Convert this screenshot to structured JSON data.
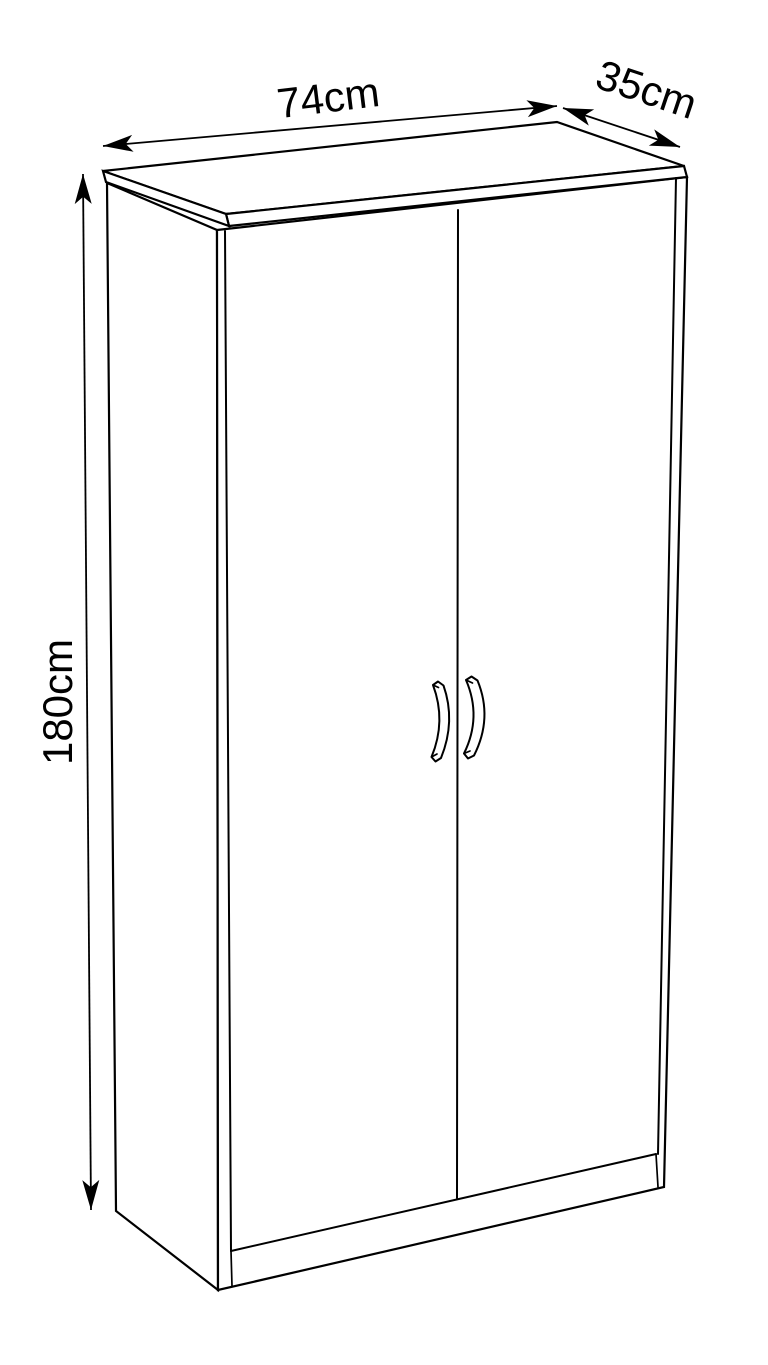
{
  "page": {
    "background_color": "#ffffff"
  },
  "diagram": {
    "kind": "furniture-dimension-line-drawing",
    "object": "two-door cabinet",
    "line_color": "#000000",
    "text_color": "#000000",
    "dimensions": {
      "width": {
        "label": "74cm",
        "value_cm": 74
      },
      "depth": {
        "label": "35cm",
        "value_cm": 35
      },
      "height": {
        "label": "180cm",
        "value_cm": 180
      }
    }
  }
}
